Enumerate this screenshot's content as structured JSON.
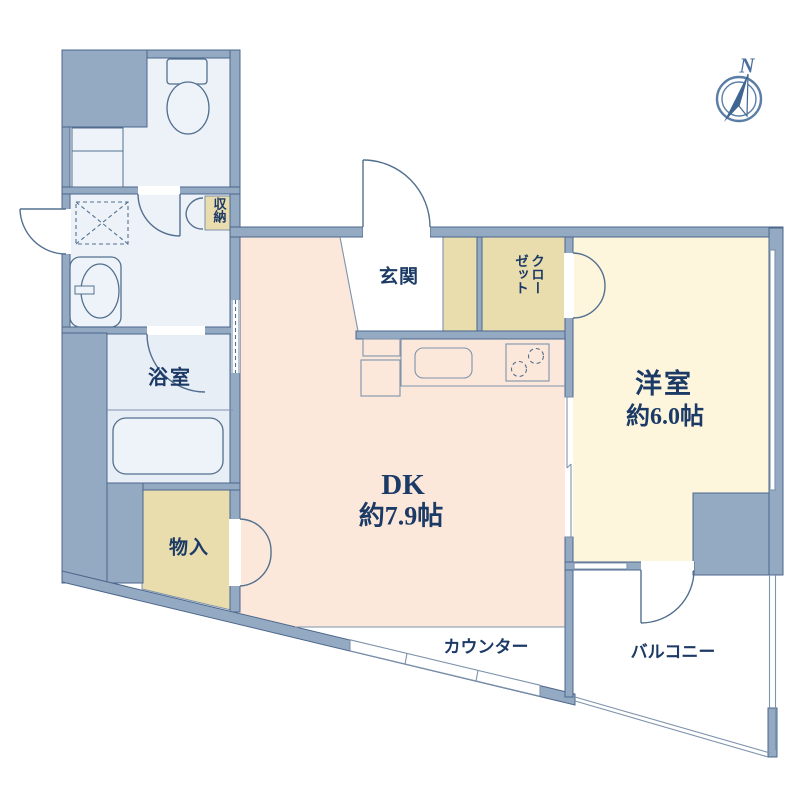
{
  "palette": {
    "wall": "#93aac2",
    "wall_line": "#4d678c",
    "line": "#53708f",
    "thin": "#7e93ac",
    "dk_floor": "#fbe8da",
    "room_floor": "#fdf6dd",
    "closet_fill": "#e9dcad",
    "wet_floor": "#edf2f8",
    "bath_floor": "#e8eef6",
    "fixture": "#eef3f9",
    "text": "#1c3a66",
    "compass": "#4a6f9b"
  },
  "compass": {
    "north": "N"
  },
  "rooms": {
    "dk": {
      "name": "DK",
      "size": "約7.9帖"
    },
    "western": {
      "name": "洋室",
      "size": "約6.0帖"
    },
    "entrance": "玄関",
    "closet": "クローゼット",
    "storage_small": "収納",
    "bathroom": "浴室",
    "storage_floor": "物入",
    "counter": "カウンター",
    "balcony": "バルコニー"
  }
}
